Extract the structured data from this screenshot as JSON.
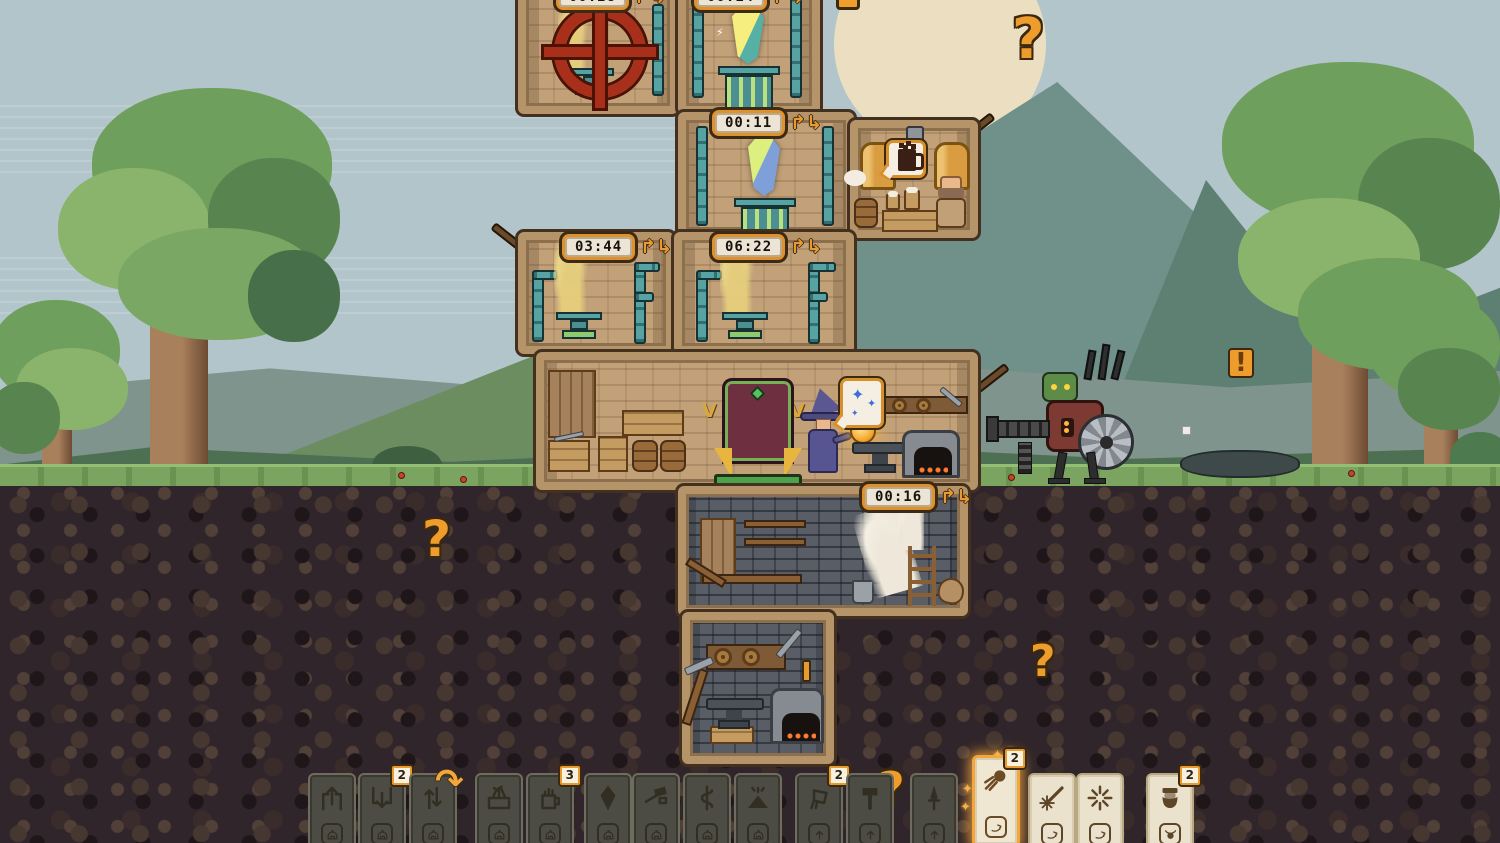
{
  "meta": {
    "scene": "pixel-wizard-tower-defense",
    "viewport": "1500x843"
  },
  "palette": {
    "accent_orange": "#ee9d2c",
    "timer_frame": "#e0912c",
    "card_highlight": "#f2a63c",
    "sky": "#b2c5ca",
    "grass": "#7aa45f",
    "stone_wall": "#c2a179",
    "underground_brick": "#585d66"
  },
  "hud": {
    "timer_arrows": "↱↳",
    "hook_glyph": "↷",
    "glow_glyph": "✦",
    "timers": [
      {
        "id": "timer-wheel-room",
        "value": "00:28",
        "x": 556,
        "y": -16
      },
      {
        "id": "timer-crystal-top",
        "value": "00:14",
        "x": 694,
        "y": -16
      },
      {
        "id": "timer-crystal",
        "value": "00:11",
        "x": 712,
        "y": 110
      },
      {
        "id": "timer-vent-left",
        "value": "03:44",
        "x": 562,
        "y": 234
      },
      {
        "id": "timer-vent-right",
        "value": "06:22",
        "x": 712,
        "y": 234
      },
      {
        "id": "timer-underground",
        "value": "00:16",
        "x": 862,
        "y": 484
      }
    ],
    "marks": [
      {
        "name": "question-mark-sky",
        "glyph": "?",
        "x": 1012,
        "y": 12,
        "size": 56,
        "boxed": false
      },
      {
        "name": "question-mark-underground-left",
        "glyph": "?",
        "x": 422,
        "y": 514,
        "size": 50,
        "boxed": false
      },
      {
        "name": "question-mark-underground-right",
        "glyph": "?",
        "x": 1030,
        "y": 640,
        "size": 44,
        "boxed": false
      },
      {
        "name": "question-mark-card-row",
        "glyph": "?",
        "x": 878,
        "y": 766,
        "size": 46,
        "boxed": false
      },
      {
        "name": "exclamation-mark-field",
        "glyph": "!",
        "x": 1228,
        "y": 348,
        "size": 26,
        "boxed": true
      }
    ]
  },
  "bubbles": {
    "brew": {
      "icon": "beer-mug-icon"
    },
    "forge": {
      "icon": "sparkles-icon",
      "sparkle_glyph": "✦"
    }
  },
  "decorations": {
    "sconce_glyph": "V"
  },
  "cards": [
    {
      "name": "card-eject-up",
      "icon": "eject-up",
      "variant": "dark",
      "x": 308,
      "slot": "helmet"
    },
    {
      "name": "card-insert-down",
      "icon": "insert-down",
      "variant": "dark",
      "x": 358,
      "slot": "helmet",
      "badge": "2"
    },
    {
      "name": "card-swap-vertical",
      "icon": "swap-vertical",
      "variant": "dark",
      "x": 409,
      "slot": "helmet",
      "hook": true
    },
    {
      "name": "card-weapon-crate",
      "icon": "weapon-crate",
      "variant": "dark",
      "x": 475,
      "slot": "helmet"
    },
    {
      "name": "card-brew-mug",
      "icon": "brew-mug",
      "variant": "dark",
      "x": 526,
      "slot": "helmet",
      "badge": "3"
    },
    {
      "name": "card-gem",
      "icon": "gem",
      "variant": "dark",
      "x": 584,
      "slot": "helmet"
    },
    {
      "name": "card-tool",
      "icon": "tool-gun",
      "variant": "dark",
      "x": 632,
      "slot": "helmet"
    },
    {
      "name": "card-serpent-staff",
      "icon": "serpent-staff",
      "variant": "dark",
      "x": 683,
      "slot": "helmet"
    },
    {
      "name": "card-spell-fan",
      "icon": "spell-fan",
      "variant": "dark",
      "x": 734,
      "slot": "helmet"
    },
    {
      "name": "card-pour-bucket",
      "icon": "pour-bucket",
      "variant": "dark",
      "x": 795,
      "slot": "arrow-up",
      "badge": "2"
    },
    {
      "name": "card-hammer",
      "icon": "hammer",
      "variant": "dark",
      "x": 846,
      "slot": "arrow-up"
    },
    {
      "name": "card-dagger",
      "icon": "dagger",
      "variant": "dark",
      "x": 910,
      "slot": "arrow-up"
    },
    {
      "name": "card-fireball",
      "icon": "fireball",
      "variant": "highlight",
      "x": 972,
      "slot": "redo-swoosh",
      "badge": "2",
      "glow": true
    },
    {
      "name": "card-spark-bolt",
      "icon": "spark-bolt",
      "variant": "light",
      "x": 1028,
      "slot": "redo-swoosh"
    },
    {
      "name": "card-burst",
      "icon": "burst",
      "variant": "light",
      "x": 1076,
      "slot": "redo-swoosh"
    },
    {
      "name": "card-dwarf",
      "icon": "dwarf-face",
      "variant": "light",
      "x": 1146,
      "slot": "bull-head",
      "badge": "2"
    }
  ]
}
